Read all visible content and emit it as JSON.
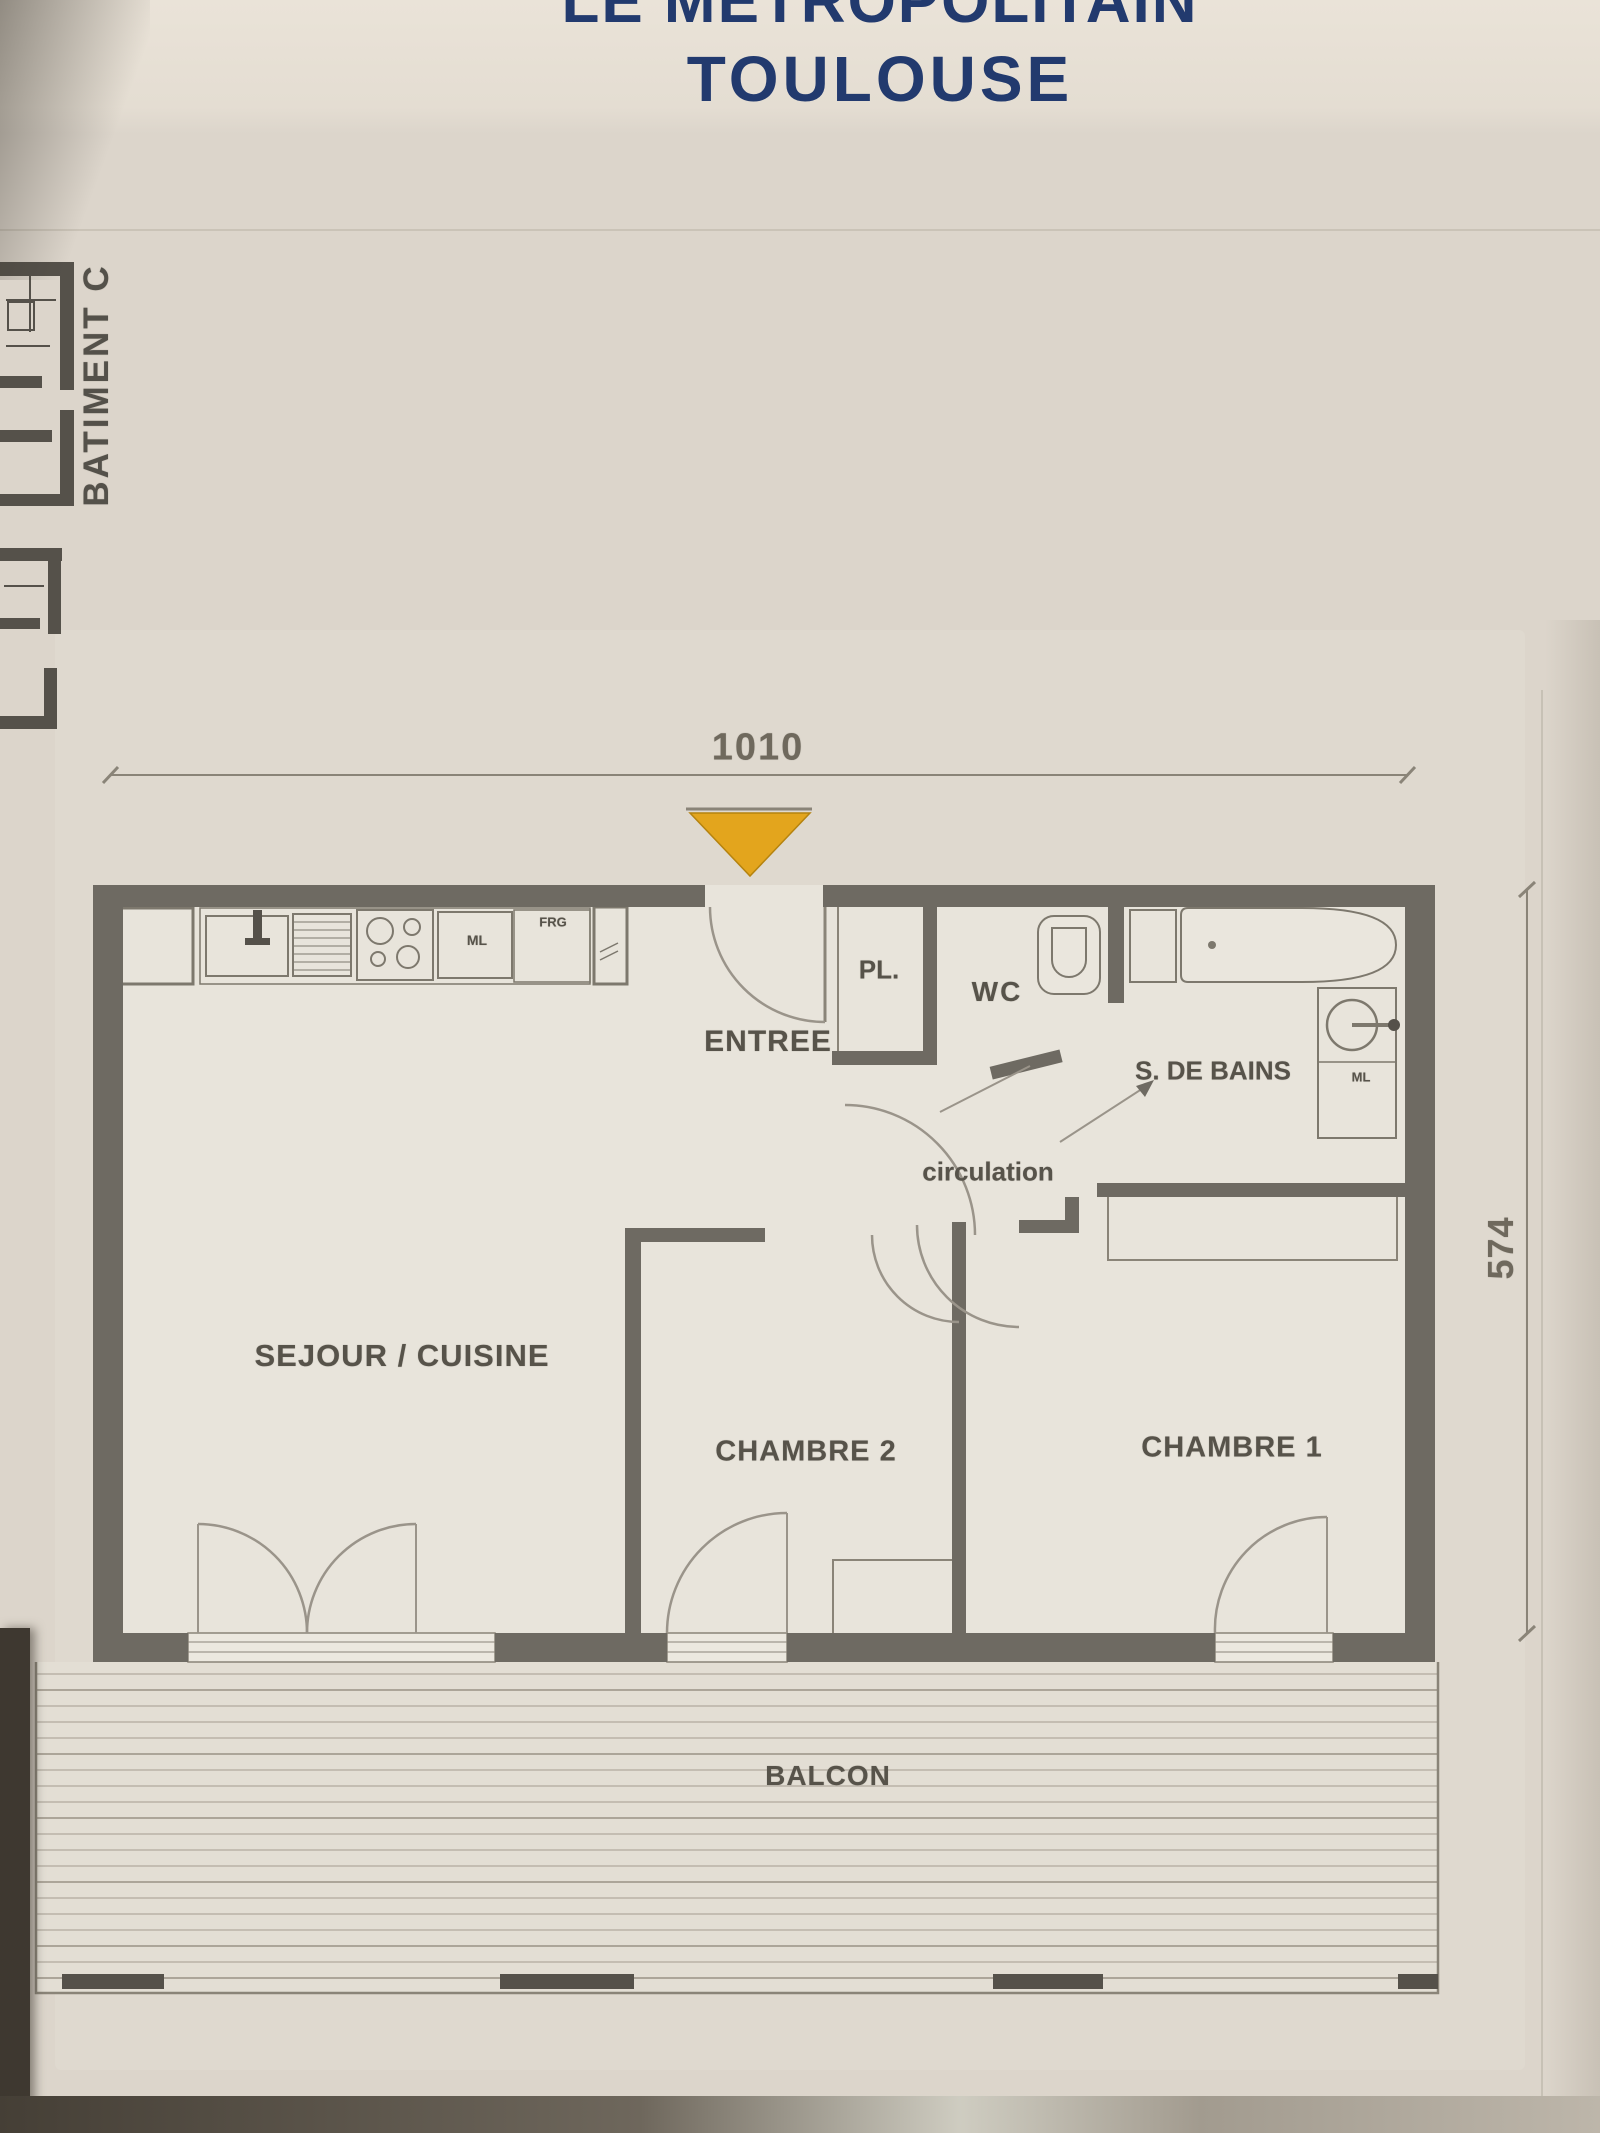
{
  "header": {
    "project_name_line1": "LE METROPOLITAIN",
    "project_name_line2": "TOULOUSE"
  },
  "key_plan": {
    "building_label": "BATIMENT C"
  },
  "dimensions": {
    "overall_width": "1010",
    "overall_depth": "574"
  },
  "rooms": {
    "entry": "ENTREE",
    "closet": "PL.",
    "wc": "WC",
    "bathroom": "S. DE BAINS",
    "hallway": "circulation",
    "living_kitchen": "SEJOUR / CUISINE",
    "bedroom2": "CHAMBRE 2",
    "bedroom1": "CHAMBRE 1",
    "balcony": "BALCON"
  },
  "appliances": {
    "kitchen_washer": "ML",
    "fridge": "FRG",
    "bath_washer": "ML"
  },
  "colors": {
    "title_navy": "#223a6e",
    "wall_gray": "#6e6a62",
    "entry_marker_orange": "#e3a51d",
    "paper_beige": "#dcd5cb",
    "label_gray": "#57534a"
  }
}
